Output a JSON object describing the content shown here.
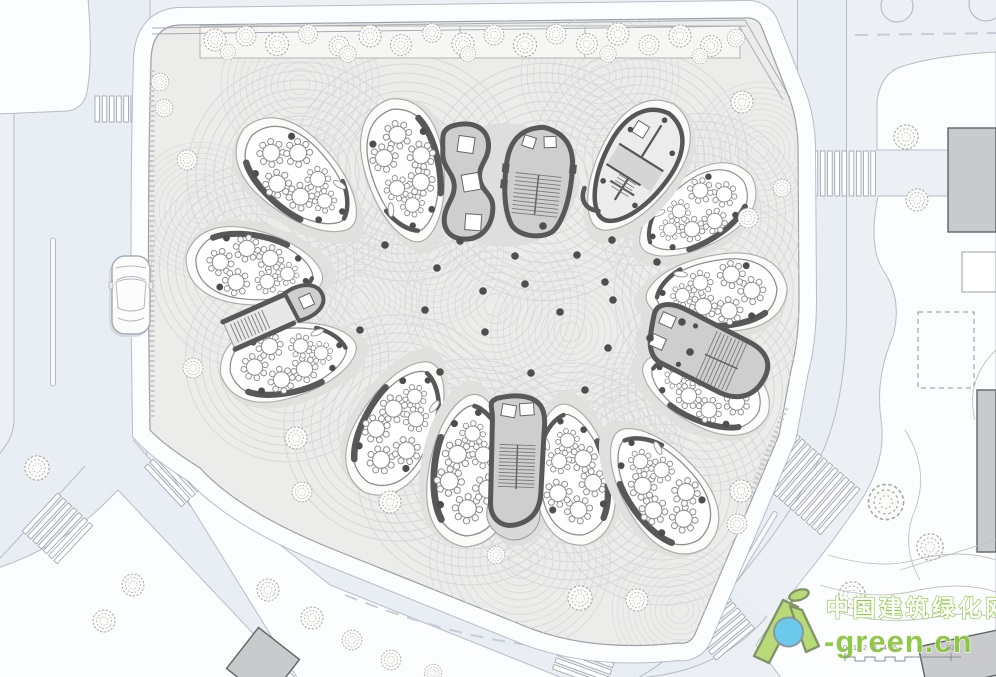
{
  "watermark": {
    "site_name": "中国建筑绿化网",
    "site_url": "-green.cn"
  },
  "scale_bar": {
    "labels": [
      "0",
      "1",
      "2",
      "3",
      "4",
      "5",
      "10"
    ]
  },
  "plan": {
    "classroom_units": 11,
    "service_units": 1,
    "stair_structures": 5,
    "tables_per_unit": 6,
    "crosswalks": 7,
    "cars": 1
  },
  "icons": {
    "tree-icon": "scribbled plan-view tree canopy",
    "flower-table-icon": "round table with 8 chairs",
    "car-icon": "top view car",
    "stair-icon": "parallel tread lines",
    "crosswalk-icon": "zebra stripes",
    "logo-house-icon": "green A-shaped house",
    "logo-leaf-icon": "green leaf",
    "scale-bar-icon": "stepped graphic scale"
  },
  "colors": {
    "page_bg": "#ecf0f5",
    "road_tint": "#e9edf4",
    "curb": "#b7bdc6",
    "parcel_white": "#fcfdfe",
    "site_paving": "#ececeb",
    "paving_arc": "#d8d9da",
    "wall_dark": "#585858",
    "core_fill": "#cecece",
    "building_gray": "#c8cacb",
    "tree_stroke": "#a2a6a4",
    "brand_green": "#8cc63e",
    "logo_green_fill": "#b6da70",
    "logo_green_edge": "#7d9060",
    "logo_blue": "#63c8ea",
    "scale_text": "#8a8f94"
  }
}
